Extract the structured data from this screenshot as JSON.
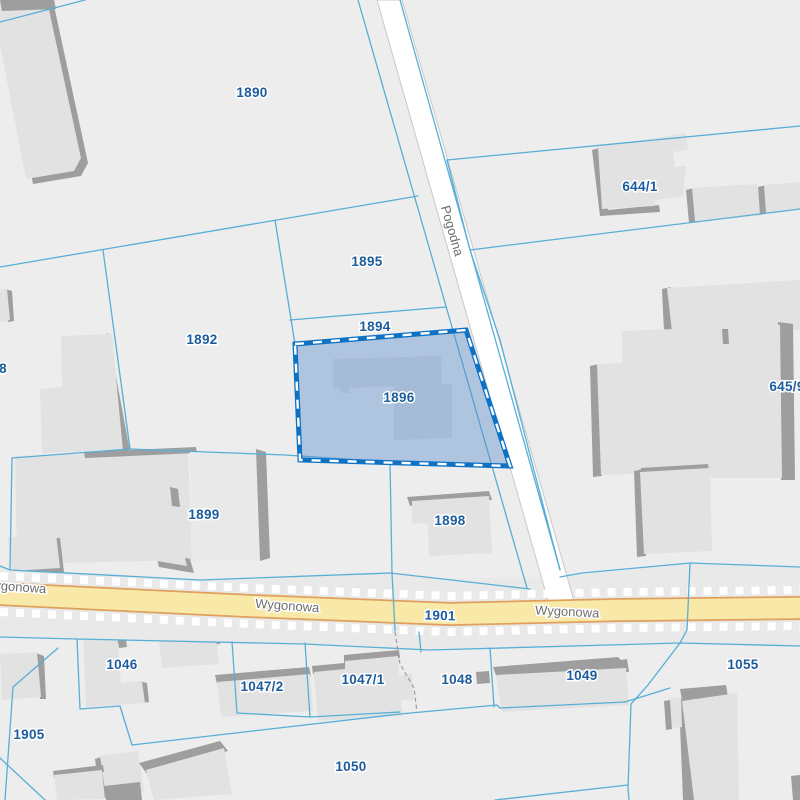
{
  "map": {
    "parcels": {
      "p1890": "1890",
      "p1895": "1895",
      "p1894": "1894",
      "p1892": "1892",
      "p1896": "1896",
      "p644_1": "644/1",
      "p645_9": "645/9",
      "p8": "8",
      "p1899": "1899",
      "p1898": "1898",
      "p1901": "1901",
      "p1046": "1046",
      "p1905": "1905",
      "p1047_2": "1047/2",
      "p1047_1": "1047/1",
      "p1048": "1048",
      "p1049": "1049",
      "p1055": "1055",
      "p1050": "1050"
    },
    "streets": {
      "pogodna": "Pogodna",
      "wygonowa": "Wygonowa"
    },
    "selection": {
      "selected_parcel": "1896"
    },
    "colors": {
      "parcel_background": "#ededed",
      "parcel_boundary": "#58aed6",
      "parcel_label": "#1c5c9e",
      "street_label": "#6e6e6e",
      "building_fill": "#e2e2e2",
      "building_shadow": "#9e9e9e",
      "selection_border": "#0d72c4",
      "selection_fill": "#abc8e8",
      "road_minor_fill": "#ffffff",
      "road_major_fill": "#f9e9a8",
      "road_major_casing": "#dfa05e"
    }
  }
}
